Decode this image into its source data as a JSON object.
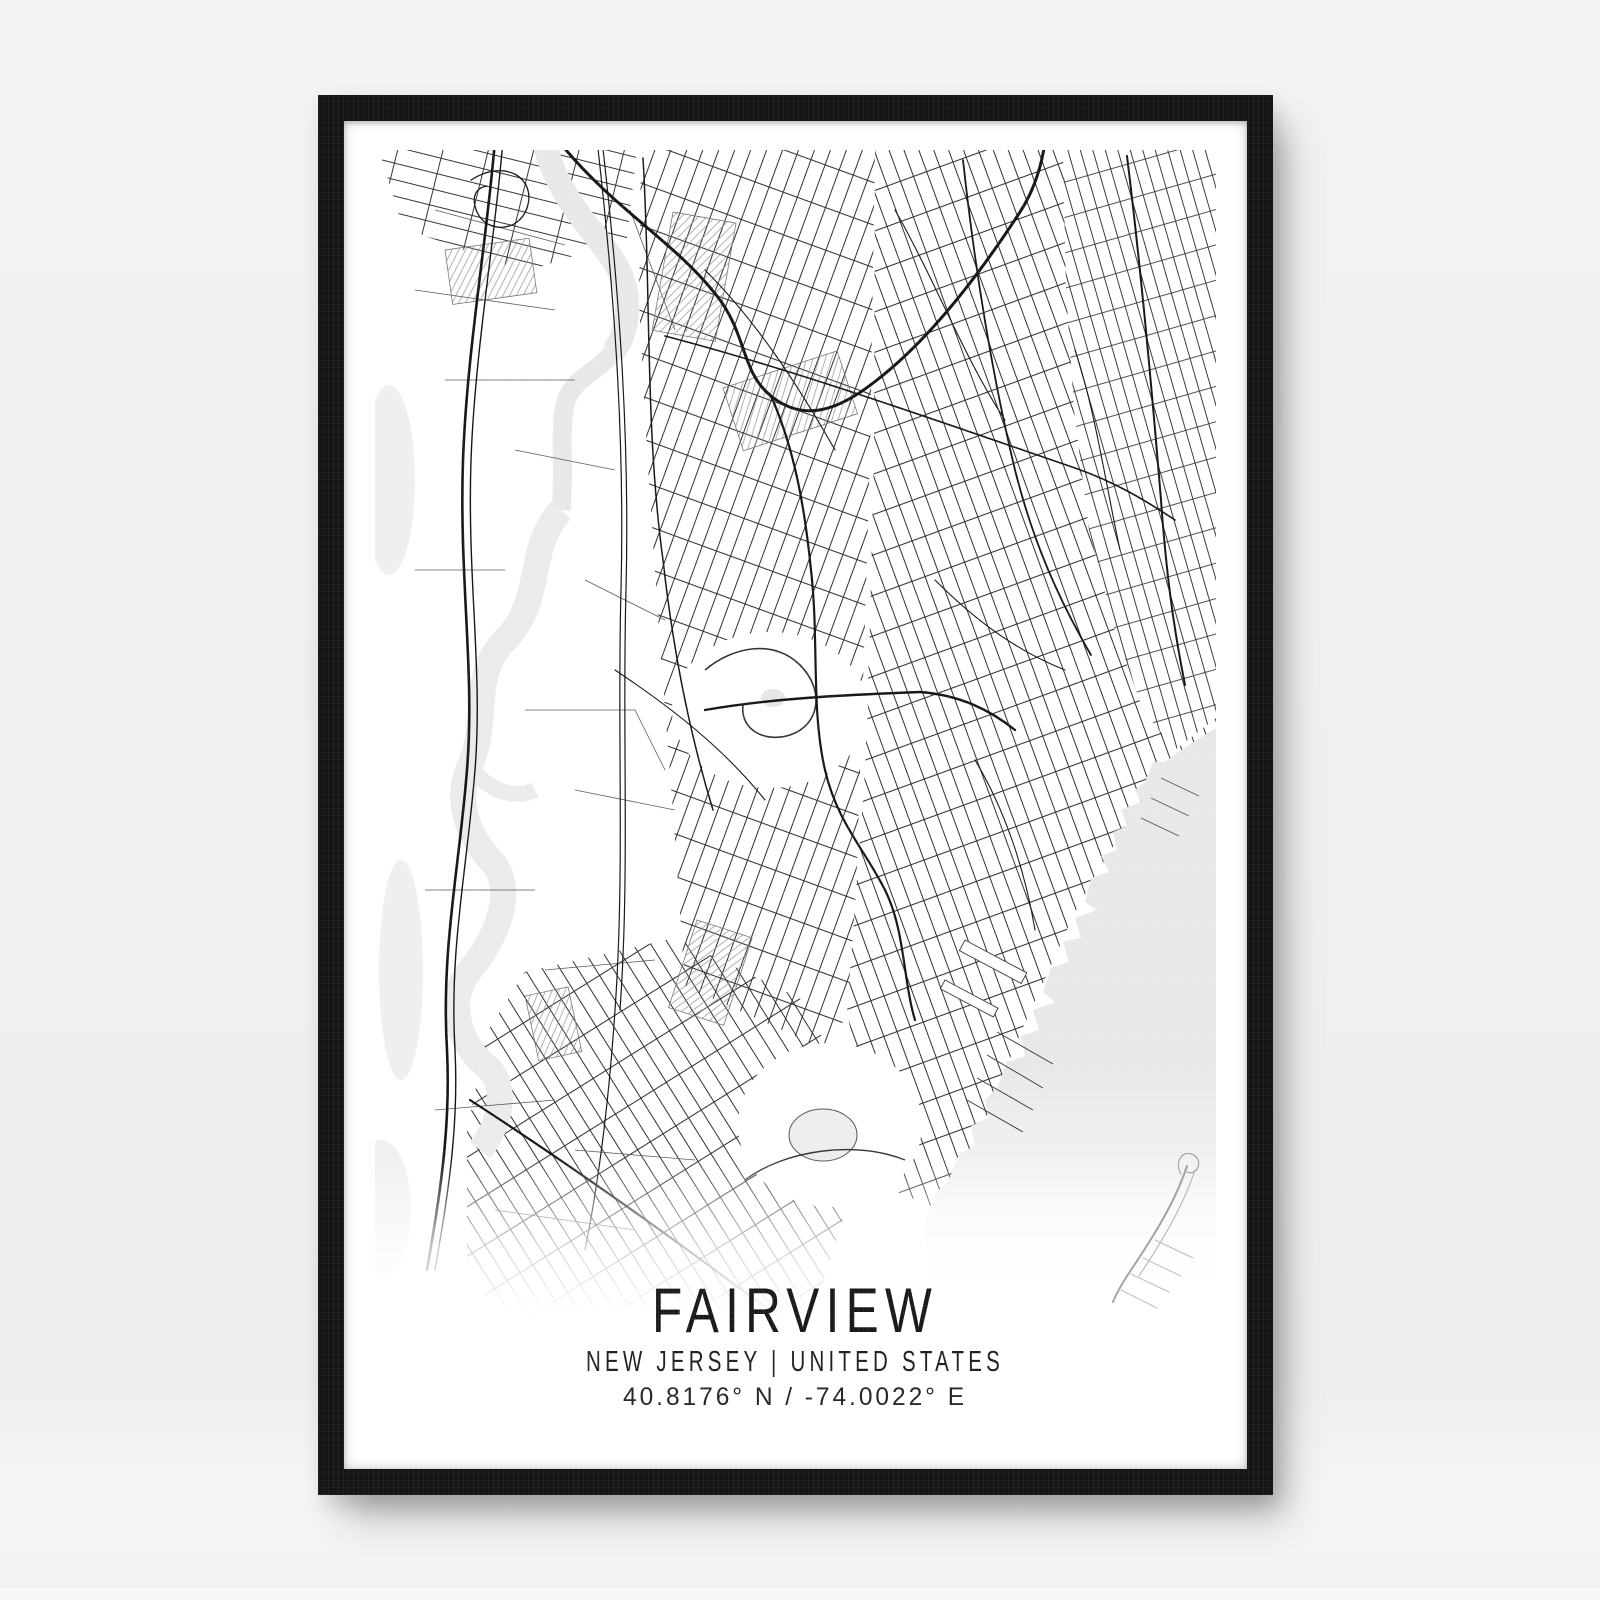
{
  "wall": {
    "background_color": "#f1f1f2"
  },
  "frame": {
    "color": "#151515"
  },
  "poster": {
    "title": "FAIRVIEW",
    "subtitle": "NEW JERSEY | UNITED STATES",
    "coordinates": "40.8176° N / -74.0022° E",
    "text_color": "#1c1c1c",
    "background_color": "#ffffff"
  },
  "map": {
    "land_color": "#ffffff",
    "water_color": "#e8e8e9",
    "road_color": "#1a1a1a"
  }
}
